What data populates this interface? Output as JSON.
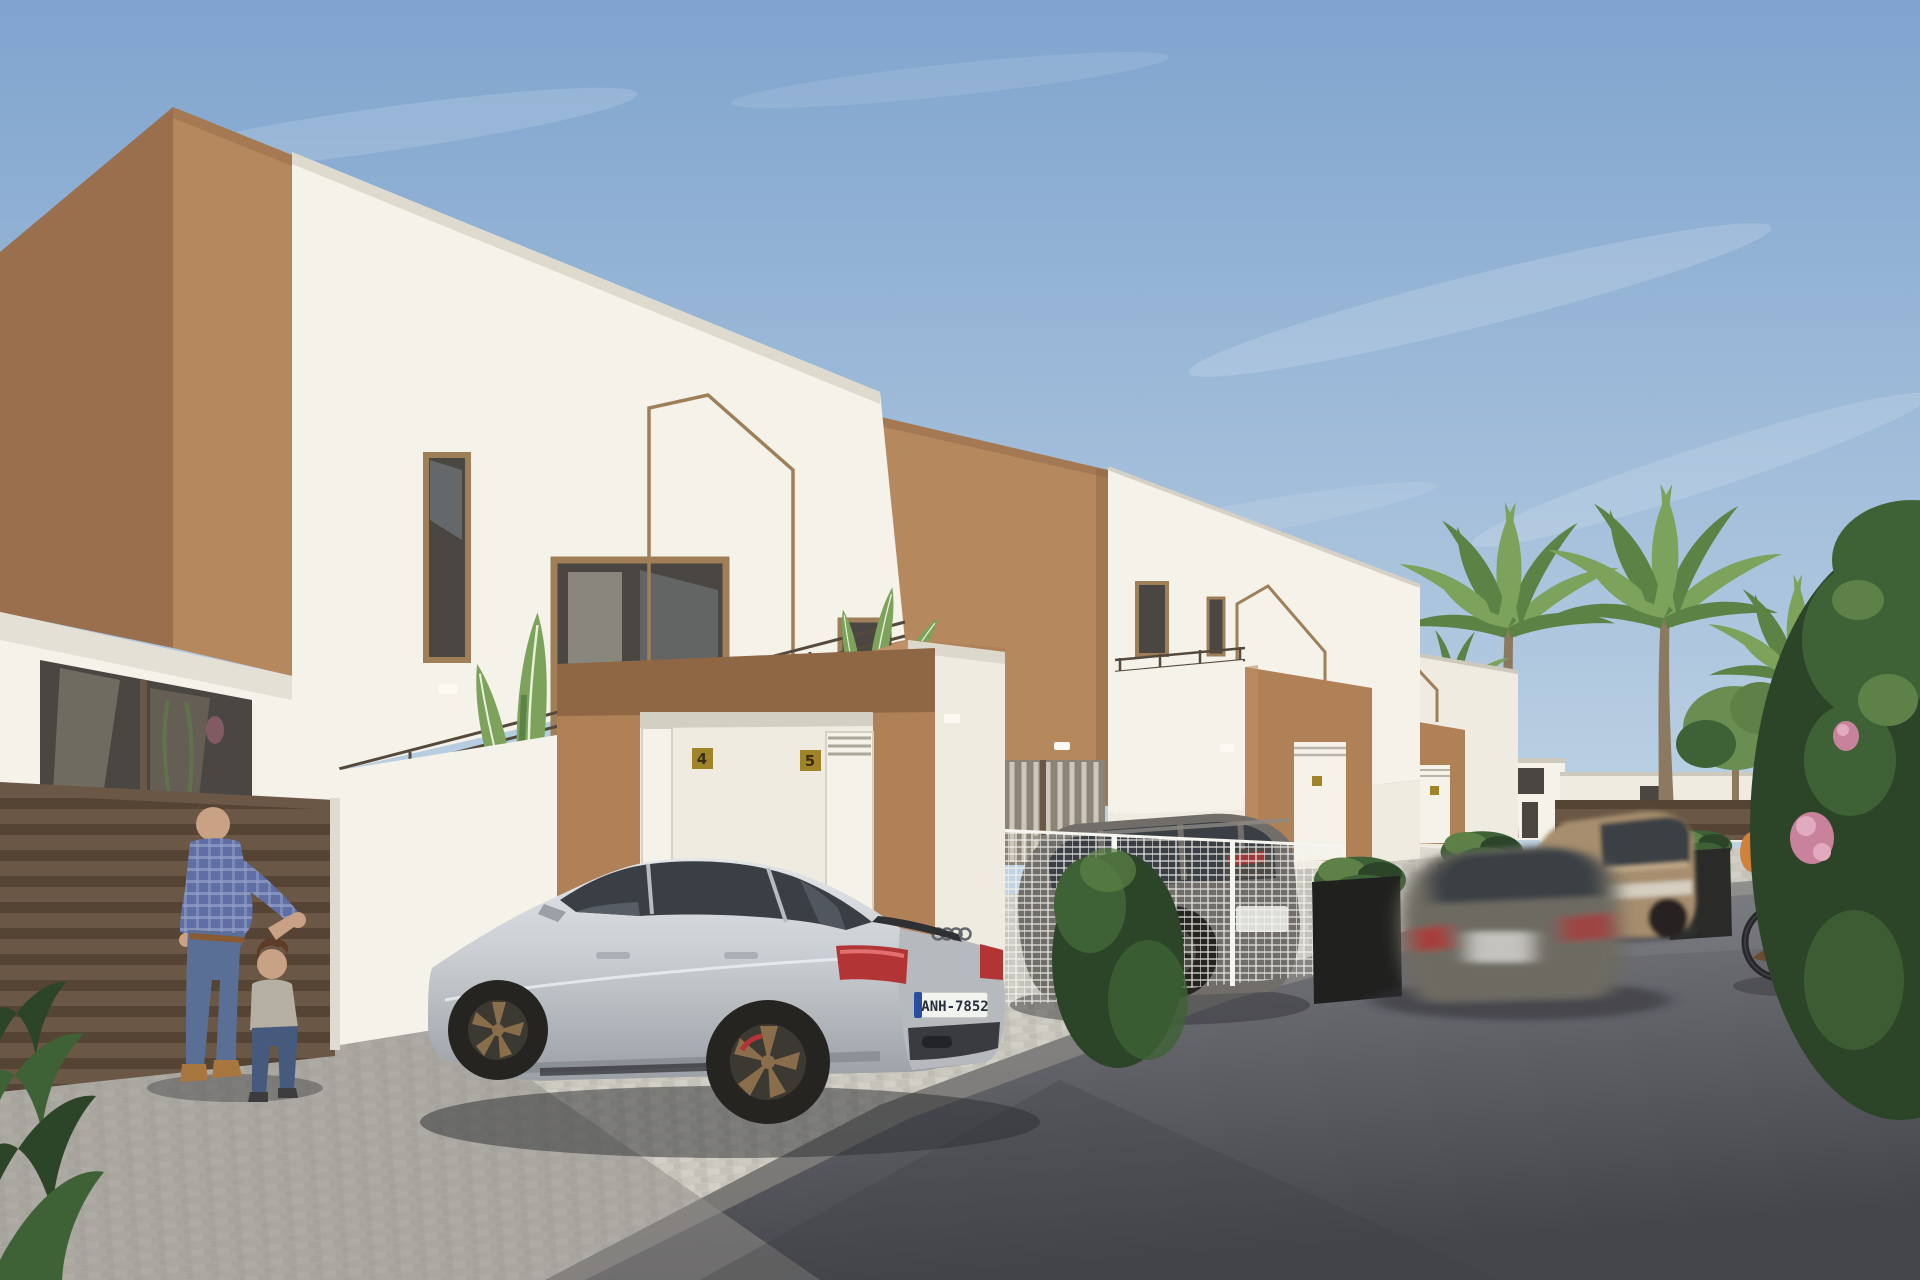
{
  "scene": {
    "type": "architectural-exterior-render",
    "description": "Daytime 3D render of a row of modern two-storey white villas with tan/brown accent cubes, garages, parked cars, palm trees, a father playing with a toddler and a woman cycling",
    "license_plate": "ANH-7852",
    "house_number_left": "4",
    "house_number_right": "5",
    "objects": [
      {
        "name": "villa-1",
        "desc": "foreground white villa with brown corner cube, balcony, gable outline motif, double garage"
      },
      {
        "name": "villa-2",
        "desc": "middle villa with brown upper cube and tan garage surround"
      },
      {
        "name": "villa-3",
        "desc": "far villa with tan garage surround"
      },
      {
        "name": "audi-sedan",
        "desc": "light silver fastback parked on paver driveway, bronze wheels"
      },
      {
        "name": "grey-suv",
        "desc": "dark grey SUV parked behind white mesh fence"
      },
      {
        "name": "moving-car",
        "desc": "motion-blurred grey hatchback driving on street"
      },
      {
        "name": "bronze-suv",
        "desc": "champagne SUV parked further down street"
      },
      {
        "name": "father-and-child",
        "desc": "man in blue plaid shirt holding hands with toddler"
      },
      {
        "name": "cyclist",
        "desc": "woman in yellow top riding bicycle"
      },
      {
        "name": "palm-trees",
        "desc": "four tall palms behind the villas"
      },
      {
        "name": "foreground-bush",
        "desc": "large green shrub with pink flowers at right edge"
      }
    ]
  },
  "palette": {
    "sky_top": "#7fa4ce",
    "sky_bottom": "#c2d5e5",
    "cloud": "#ffffff",
    "brown_dark": "#9a6f4e",
    "brown_light": "#b5885e",
    "tan": "#b08157",
    "tan_deep": "#8f6744",
    "white_lit": "#f5f2ea",
    "white_cream": "#efebe0",
    "white_shade": "#dedbd2",
    "coping": "#cdc9bc",
    "glass_dark": "#4a4742",
    "glass_light": "#8b8477",
    "frame_tan": "#9f7f58",
    "fence_brown": "#6b5745",
    "fence_brown_dark": "#554434",
    "cobble": "#c9c6bd",
    "cobble_line": "#b2afa6",
    "cobble_shadow": "#8f8d88",
    "road": "#606167",
    "road_light": "#84858a",
    "road_shadow": "#45464b",
    "car_silver": "#c9cdd1",
    "car_silver_bright": "#e2e5e8",
    "car_silver_dark": "#9aa0a6",
    "car_glass": "#3a3f45",
    "wheel_dark": "#262421",
    "wheel_bronze": "#8a6e4c",
    "tail_red": "#b23434",
    "plate_bg": "#f2f4f0",
    "plate_text": "#27303c",
    "plate_band": "#2a4fa0",
    "suv_grey": "#716d68",
    "suv_grey_dark": "#4e4b47",
    "bronze_suv": "#a78e6e",
    "blur_car": "#6d6a62",
    "palm_trunk": "#8b7a60",
    "palm_green": "#7da25c",
    "palm_green_dark": "#5c8245",
    "tree_green": "#6a8d52",
    "bush_dark": "#2c4529",
    "bush_mid": "#3f6136",
    "bush_light": "#5d8147",
    "flower_pink": "#c9829b",
    "flower_pink_light": "#e2aabf",
    "skin": "#c9a184",
    "hair_brown": "#7a5a40",
    "shirt_plaid": "#5f6fa6",
    "shirt_plaid_light": "#93a0c6",
    "jeans": "#5a6f96",
    "jeans_dark": "#465a7e",
    "shoe_tan": "#a8763f",
    "child_shirt": "#b6afa4",
    "cyclist_top": "#c6c052",
    "cyclist_pants": "#8b8678",
    "bag_orange": "#d0813c",
    "plaque_gold": "#a08428",
    "plaque_text": "#3a2f14",
    "railing": "#55493c"
  }
}
